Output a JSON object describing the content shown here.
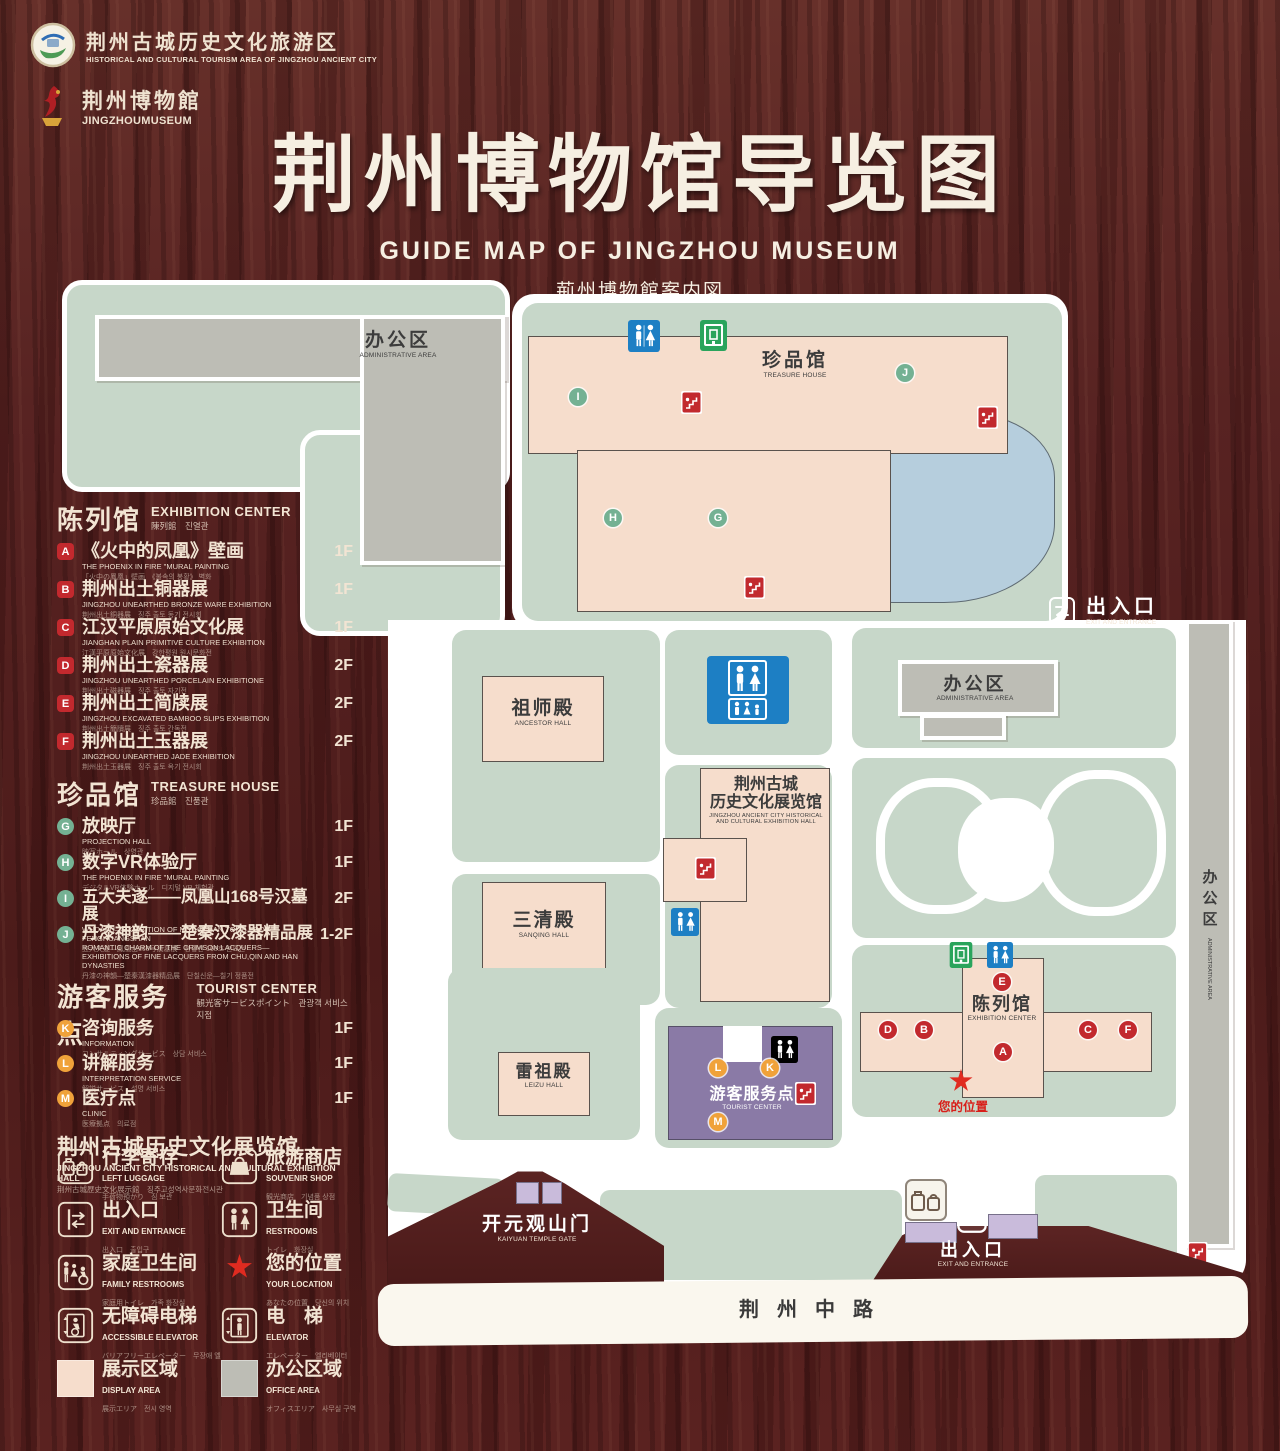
{
  "header": {
    "tourism_logo": {
      "cn": "荆州古城历史文化旅游区",
      "en": "HISTORICAL AND CULTURAL TOURISM AREA OF JINGZHOU ANCIENT CITY"
    },
    "museum_logo": {
      "cn": "荆州博物館",
      "en": "JINGZHOUMUSEUM"
    },
    "title_cn": "荆州博物馆导览图",
    "title_en": "GUIDE MAP OF JINGZHOU MUSEUM",
    "title_jp": "荊州博物館案内図",
    "title_kr": "징주박물관 안내도"
  },
  "sidebar": {
    "exhibition": {
      "title_cn": "陈列馆",
      "title_en": "EXHIBITION CENTER",
      "title_sub": "陳列館　진열관",
      "items": [
        {
          "letter": "A",
          "cn": "《火中的凤凰》壁画",
          "en": "THE PHOENIX IN FIRE \"MURAL PAINTING",
          "sub": "「火中の鳳凰」壁画　《불속의 봉황》 벽화",
          "floor": "1F"
        },
        {
          "letter": "B",
          "cn": "荆州出土铜器展",
          "en": "JINGZHOU UNEARTHED BRONZE WARE EXHIBITION",
          "sub": "荆州出土銅器展　징주 출토 동기 전시회",
          "floor": "1F"
        },
        {
          "letter": "C",
          "cn": "江汉平原原始文化展",
          "en": "JIANGHAN PLAIN PRIMITIVE CULTURE EXHIBITION",
          "sub": "江漢平原原始文化展　강한평원 원시문화전",
          "floor": "1F"
        },
        {
          "letter": "D",
          "cn": "荆州出土瓷器展",
          "en": "JINGZHOU UNEARTHED PORCELAIN EXHIBITIONE",
          "sub": "荆州出土磁器展　징주 출토 자기전",
          "floor": "2F"
        },
        {
          "letter": "E",
          "cn": "荆州出土简牍展",
          "en": "JINGZHOU EXCAVATED BAMBOO SLIPS EXHIBITION",
          "sub": "荆州出土簡牘展　징주 출토 간독전",
          "floor": "2F"
        },
        {
          "letter": "F",
          "cn": "荆州出土玉器展",
          "en": "JINGZHOU UNEARTHED JADE EXHIBITION",
          "sub": "荆州出土玉器展　징주 출토 옥기 전시회",
          "floor": "2F"
        }
      ]
    },
    "treasure": {
      "title_cn": "珍品馆",
      "title_en": "TREASURE HOUSE",
      "title_sub": "珍品館　진품관",
      "items": [
        {
          "letter": "G",
          "cn": "放映厅",
          "en": "PROJECTION HALL",
          "sub": "映写ホール　상영관",
          "floor": "1F"
        },
        {
          "letter": "H",
          "cn": "数字VR体验厅",
          "en": "THE PHOENIX IN FIRE \"MURAL PAINTING",
          "sub": "デジタルVR体験ホール　디지털 VR 체험관",
          "floor": "1F"
        },
        {
          "letter": "I",
          "cn": "五大夫遂——凤凰山168号汉墓展",
          "en": "WUDAFU—EXHIBITION OF NO.168 HAN TOMB FROM FENGHUANGSHAN",
          "sub": "五大夫遂—鳳凰山168号漢墓展　봉황산 168호 한묘전",
          "floor": "2F"
        },
        {
          "letter": "J",
          "cn": "丹漆神韵——楚秦汉漆器精品展",
          "en": "ROMANTIC CHARM OF THE CRIMSON LACQUERS—EXHIBITIONS OF FINE LACQUERS FROM CHU,QIN AND HAN DYNASTIES",
          "sub": "丹漆の神韻—楚秦漢漆器精品展　단칠신운—칠기 정품전",
          "floor": "1-2F"
        }
      ]
    },
    "tourist": {
      "title_cn": "游客服务点",
      "title_en": "TOURIST CENTER",
      "title_sub": "観光客サービスポイント　관광객 서비스 지점",
      "items": [
        {
          "letter": "K",
          "cn": "咨询服务",
          "en": "INFORMATION",
          "sub": "コンサルティングサービス　상담 서비스",
          "floor": "1F"
        },
        {
          "letter": "L",
          "cn": "讲解服务",
          "en": "INTERPRETATION SERVICE",
          "sub": "解説サービス　설명 서비스",
          "floor": "1F"
        },
        {
          "letter": "M",
          "cn": "医疗点",
          "en": "CLINIC",
          "sub": "医療拠点　의료점",
          "floor": "1F"
        }
      ]
    },
    "hall_note": {
      "cn": "荆州古城历史文化展览馆",
      "en": "JINGZHOU ANCIENT CITY HISTORICAL AND CULTURAL EXHIBITION HALL",
      "sub": "荆州古城歴史文化展示館　징주고성역사문화전시관"
    },
    "legend": [
      {
        "cn": "行李寄存",
        "en": "LEFT LUGGAGE",
        "sub": "手荷物預かり　짐 보관"
      },
      {
        "cn": "旅游商店",
        "en": "SOUVENIR SHOP",
        "sub": "観光商店　기념품 상점"
      },
      {
        "cn": "出入口",
        "en": "EXIT AND ENTRANCE",
        "sub": "出入口　출입구"
      },
      {
        "cn": "卫生间",
        "en": "RESTROOMS",
        "sub": "トイレ　화장실"
      },
      {
        "cn": "家庭卫生间",
        "en": "FAMILY RESTROOMS",
        "sub": "家庭用トイレ　가족 화장실"
      },
      {
        "cn": "您的位置",
        "en": "YOUR LOCATION",
        "sub": "あなたの位置　당신의 위치"
      },
      {
        "cn": "无障碍电梯",
        "en": "ACCESSIBLE ELEVATOR",
        "sub": "バリアフリーエレベーター　무장애 엘리베이터"
      },
      {
        "cn": "电　梯",
        "en": "ELEVATOR",
        "sub": "エレベーター　엘리베이터"
      },
      {
        "cn": "展示区域",
        "en": "DISPLAY AREA",
        "sub": "展示エリア　전시 영역"
      },
      {
        "cn": "办公区域",
        "en": "OFFICE AREA",
        "sub": "オフィスエリア　사무실 구역"
      }
    ]
  },
  "map": {
    "admin_nw": {
      "cn": "办公区",
      "en": "ADMINISTRATIVE AREA"
    },
    "treasure_house": {
      "cn": "珍品馆",
      "en": "TREASURE HOUSE"
    },
    "exit_east": {
      "cn": "出入口",
      "en": "EXIT AND ENTRANCE"
    },
    "admin_east": {
      "cn": "办公区",
      "en": "ADMINISTRATIVE AREA"
    },
    "admin_strip": {
      "cn": "办公区",
      "en": "ADMINISTRATIVE AREA"
    },
    "ancestor_hall": {
      "cn": "祖师殿",
      "en": "ANCESTOR HALL"
    },
    "history_hall": {
      "cn1": "荆州古城",
      "cn2": "历史文化展览馆",
      "en1": "JINGZHOU ANCIENT CITY HISTORICAL",
      "en2": "AND CULTURAL EXHIBITION HALL"
    },
    "sanqing_hall": {
      "cn": "三清殿",
      "en": "SANQING HALL"
    },
    "leizu_hall": {
      "cn": "雷祖殿",
      "en": "LEIZU HALL"
    },
    "tourist_center": {
      "cn": "游客服务点",
      "en": "TOURIST CENTER"
    },
    "exhibition_center": {
      "cn": "陈列馆",
      "en": "EXHIBITION CENTER"
    },
    "your_location": {
      "cn": "您的位置"
    },
    "kaiyuan_gate": {
      "cn": "开元观山门",
      "en": "KAIYUAN TEMPLE GATE"
    },
    "exit_south": {
      "cn": "出入口",
      "en": "EXIT AND ENTRANCE"
    },
    "road": {
      "cn": "荆州中路"
    },
    "markers": {
      "A": "A",
      "B": "B",
      "C": "C",
      "D": "D",
      "E": "E",
      "F": "F",
      "G": "G",
      "H": "H",
      "I": "I",
      "J": "J",
      "K": "K",
      "L": "L",
      "M": "M"
    }
  },
  "colors": {
    "wood": "#5a2120",
    "display_area": "#f6ddcc",
    "office_area": "#bdbdb5",
    "ground": "#c7d7c9",
    "lake": "#b6cedd",
    "tourist_purple": "#8a7aa6",
    "gate_lavender": "#c9bbdb",
    "marker_red": "#c2292e",
    "marker_green": "#74b193",
    "marker_orange": "#f0a23a",
    "restroom_blue": "#1d7fc4",
    "exit_green": "#2aa45c",
    "star_red": "#e02b20",
    "cream": "#f2e4d3"
  }
}
